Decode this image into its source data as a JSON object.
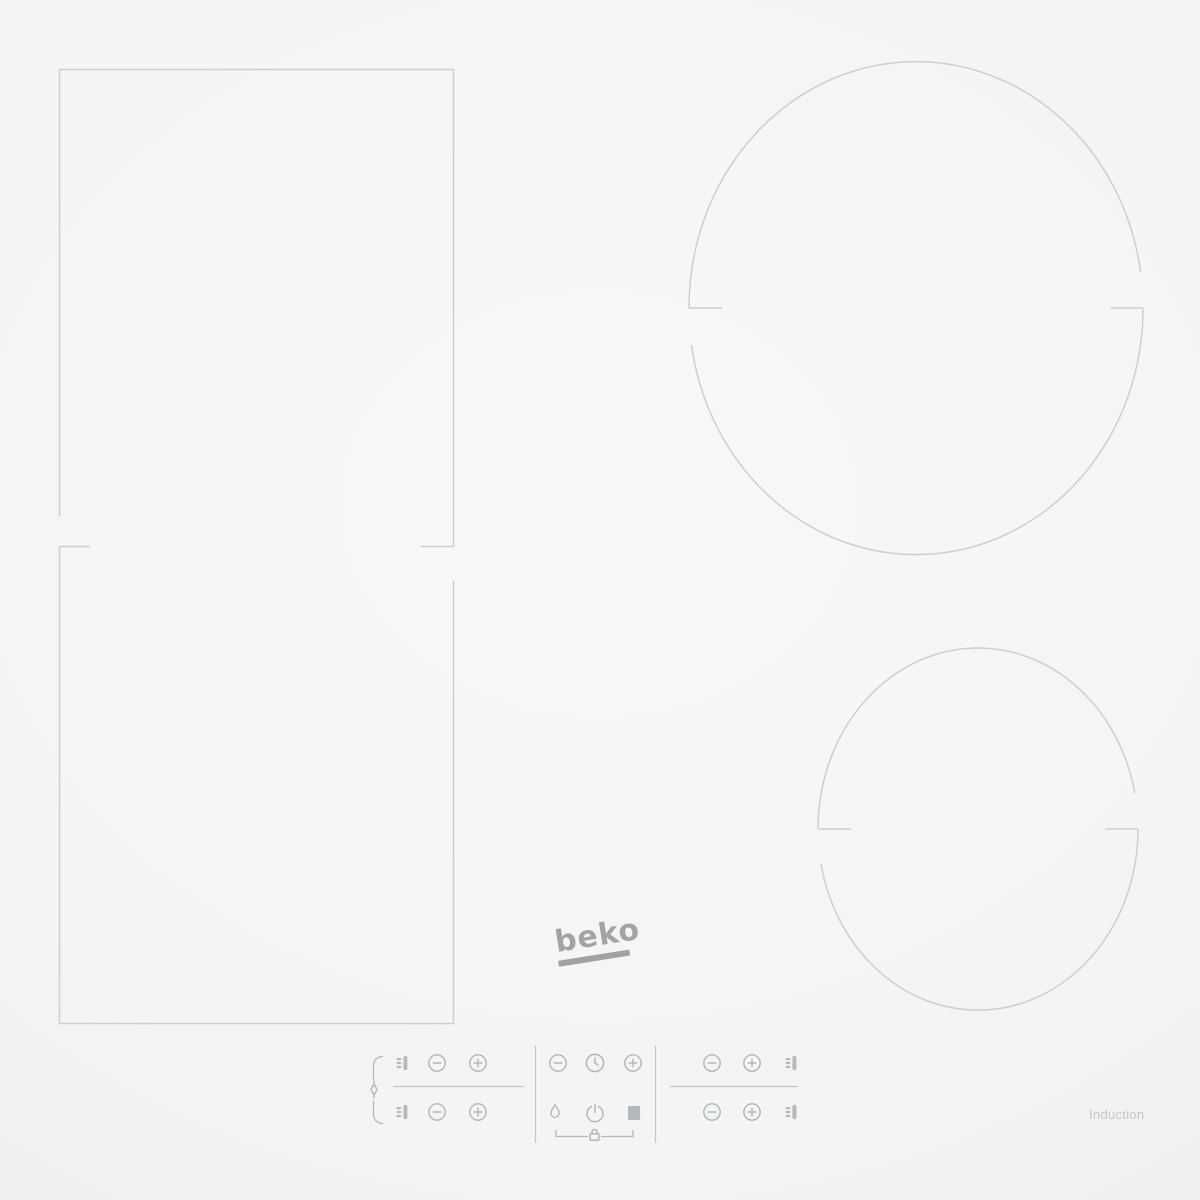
{
  "branding": {
    "logo_text": "beko",
    "induction_label": "Induction"
  },
  "colors": {
    "surface_center": "#f7f8f8",
    "surface_edge": "#e9eaea",
    "zone_outline": "#cccfd1",
    "control_icon": "#b2b6b8",
    "logo_gray": "#a2a3a4",
    "induction_label_gray": "#c6c7c8"
  },
  "zones": [
    {
      "name": "flex-zone-top-left",
      "shape": "rectangle"
    },
    {
      "name": "flex-zone-bottom-left",
      "shape": "rectangle"
    },
    {
      "name": "cooking-zone-top-right",
      "shape": "circle",
      "size": "large"
    },
    {
      "name": "cooking-zone-bottom-right",
      "shape": "circle",
      "size": "medium"
    }
  ],
  "control_panel": {
    "left_zone_controls": {
      "link_indicator": "flex-zone-link-icon",
      "rows": [
        [
          "pan-zone-icon",
          "minus-button",
          "plus-button"
        ],
        [
          "pan-zone-icon",
          "minus-button",
          "plus-button"
        ]
      ]
    },
    "center_controls": {
      "top_row": [
        "timer-minus-button",
        "timer-clock-button",
        "timer-plus-button"
      ],
      "bottom_row": [
        "boost-flame-button",
        "power-button",
        "stop-button"
      ],
      "lock_indicator": "key-lock-icon"
    },
    "right_zone_controls": {
      "rows": [
        [
          "minus-button",
          "plus-button",
          "pan-zone-icon"
        ],
        [
          "minus-button",
          "plus-button",
          "pan-zone-icon"
        ]
      ]
    }
  }
}
